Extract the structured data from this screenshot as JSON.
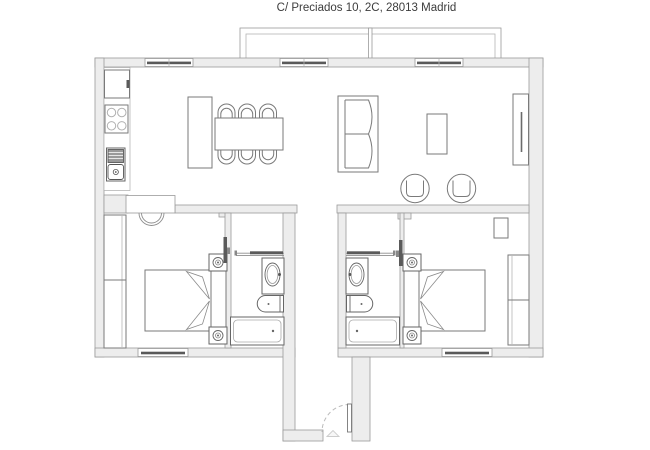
{
  "title": "C/ Preciados 10, 2C, 28013 Madrid",
  "colors": {
    "background": "#ffffff",
    "wall_fill": "#ededed",
    "wall_stroke": "#9a9a9a",
    "furniture_stroke": "#7a7a7a",
    "fixture_stroke": "#666666",
    "dark_detail": "#5a5a5a",
    "door_arc": "#bbbbbb",
    "title_text": "#3c3c3c"
  },
  "floorplan": {
    "areas": [
      "balcony",
      "kitchen-dining",
      "living-room",
      "bedroom-1",
      "bathroom-1",
      "entry-hall",
      "bathroom-2",
      "bedroom-2"
    ],
    "symbols": {
      "kitchen": [
        "fridge",
        "stove-4-burners",
        "sink-with-drainboard",
        "island-counter",
        "dining-table",
        "dining-chairs-x6"
      ],
      "living_room": [
        "sofa-2-seat",
        "coffee-table",
        "armchair-x2",
        "tv-sideboard"
      ],
      "bedroom_1": [
        "double-bed",
        "nightstand-lamp-x2",
        "wardrobe",
        "window",
        "swing-door"
      ],
      "bathroom_1": [
        "washbasin",
        "toilet",
        "bathtub",
        "sliding-door"
      ],
      "bedroom_2": [
        "double-bed",
        "nightstand-lamp-x2",
        "wardrobe",
        "small-cabinet",
        "window"
      ],
      "bathroom_2": [
        "washbasin",
        "toilet",
        "bathtub",
        "sliding-door"
      ],
      "facade": [
        "balcony",
        "window-x3",
        "entry-door-swing"
      ]
    }
  }
}
